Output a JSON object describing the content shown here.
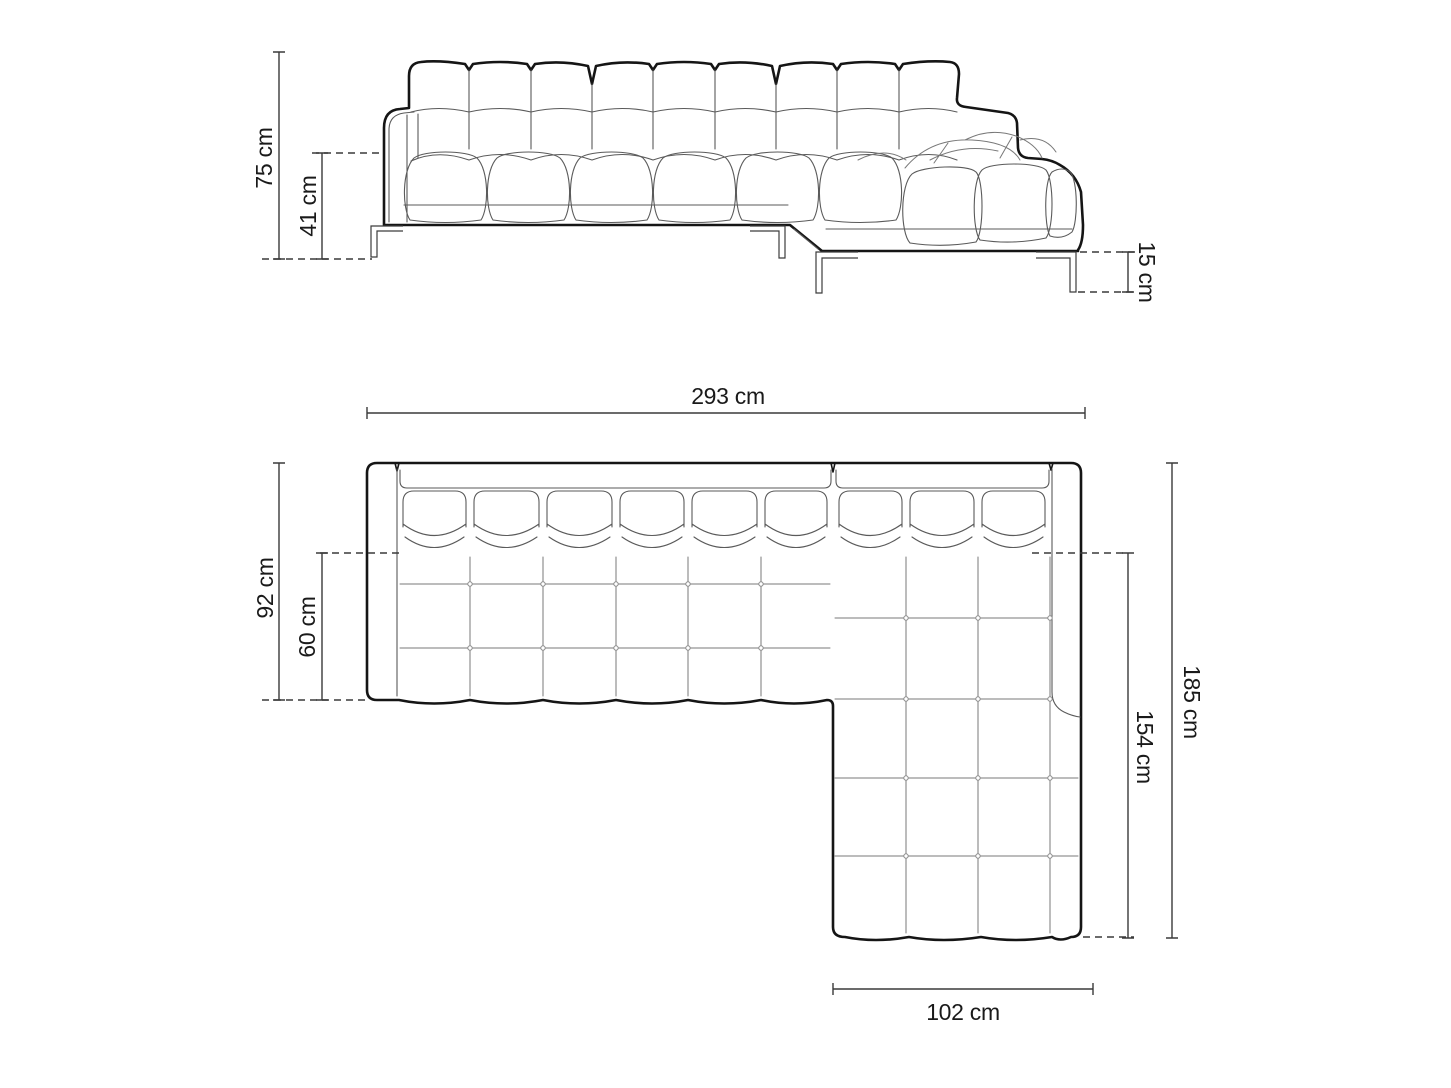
{
  "page": {
    "background": "#ffffff",
    "type": "furniture-dimension-diagram",
    "subject": "corner sofa with chaise longue, front elevation (top) and top plan view (bottom)"
  },
  "labels": {
    "overall_height": "75 cm",
    "seat_height": "41 cm",
    "leg_height": "15 cm",
    "overall_width": "293 cm",
    "body_depth": "92 cm",
    "seat_depth": "60 cm",
    "overall_depth": "185 cm",
    "chaise_length": "154 cm",
    "chaise_width": "102 cm"
  },
  "views": {
    "front_elevation": {
      "name": "front elevation",
      "dimensions": [
        {
          "name": "overall-height",
          "value": 75,
          "unit": "cm"
        },
        {
          "name": "seat-height",
          "value": 41,
          "unit": "cm"
        },
        {
          "name": "leg-height",
          "value": 15,
          "unit": "cm"
        }
      ]
    },
    "top_plan": {
      "name": "top plan view",
      "dimensions": [
        {
          "name": "overall-width",
          "value": 293,
          "unit": "cm"
        },
        {
          "name": "body-depth",
          "value": 92,
          "unit": "cm"
        },
        {
          "name": "seat-depth",
          "value": 60,
          "unit": "cm"
        },
        {
          "name": "overall-depth",
          "value": 185,
          "unit": "cm"
        },
        {
          "name": "chaise-length",
          "value": 154,
          "unit": "cm"
        },
        {
          "name": "chaise-width",
          "value": 102,
          "unit": "cm"
        }
      ]
    }
  },
  "colors": {
    "outline": "#151515",
    "detail": "#5a5a5a",
    "dimension": "#3a3a3a",
    "text": "#1a1a1a",
    "background": "#ffffff"
  }
}
